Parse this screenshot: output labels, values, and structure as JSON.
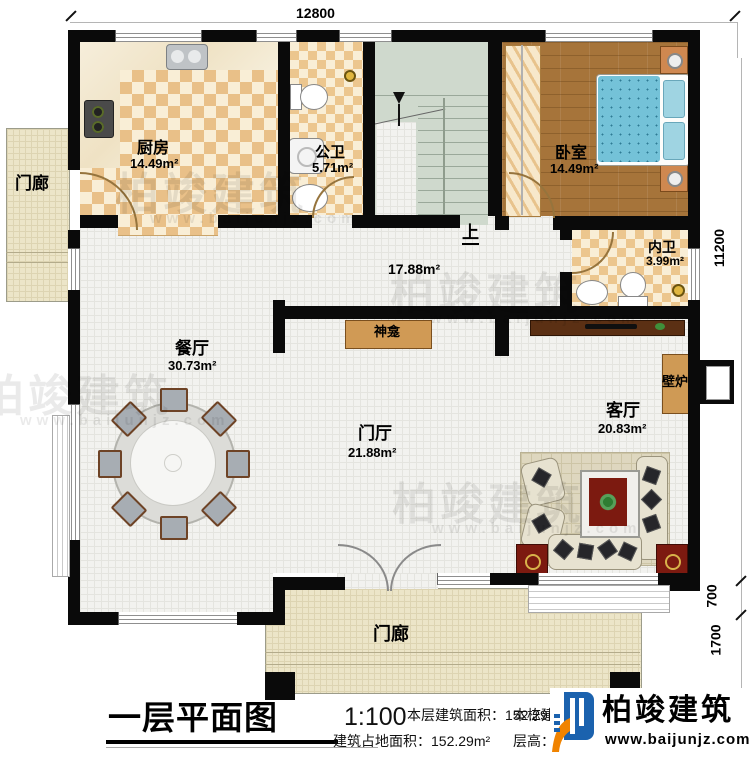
{
  "plan": {
    "dimensions": {
      "top": "12800",
      "right_total": "11200",
      "right_bay": "700",
      "right_porch": "1700"
    },
    "rooms": {
      "kitchen": {
        "name": "厨房",
        "area": "14.49m²"
      },
      "public_bath": {
        "name": "公卫",
        "area": "5.71m²"
      },
      "bedroom": {
        "name": "卧室",
        "area": "14.49m²"
      },
      "inner_bath": {
        "name": "内卫",
        "area": "3.99m²"
      },
      "hallway": {
        "area": "17.88m²"
      },
      "dining": {
        "name": "餐厅",
        "area": "30.73m²"
      },
      "foyer": {
        "name": "门厅",
        "area": "21.88m²"
      },
      "living": {
        "name": "客厅",
        "area": "20.83m²"
      },
      "porch_left": {
        "name": "门廊"
      },
      "porch_front": {
        "name": "门廊"
      },
      "shrine": {
        "name": "神龛"
      },
      "fireplace": {
        "name": "壁炉"
      },
      "stairs": {
        "direction_label": "上"
      }
    }
  },
  "title_block": {
    "title": "一层平面图",
    "scale": "1:100",
    "floor_area_label": "本层建筑面积：",
    "floor_area_value": "152.29m²",
    "footprint_label": "建筑占地面积：",
    "footprint_value": "152.29m²",
    "building_area_label": "本栋建筑面积：",
    "building_area_value": "452.8m²",
    "floor_height_label": "层高：",
    "floor_height_value": "3.6m"
  },
  "branding": {
    "name": "柏竣建筑",
    "website": "www.baijunjz.com",
    "brand_blue": "#1b62ae",
    "brand_orange": "#f08300"
  },
  "watermark": {
    "name": "柏竣建筑",
    "website": "www.baijunjz.com"
  }
}
